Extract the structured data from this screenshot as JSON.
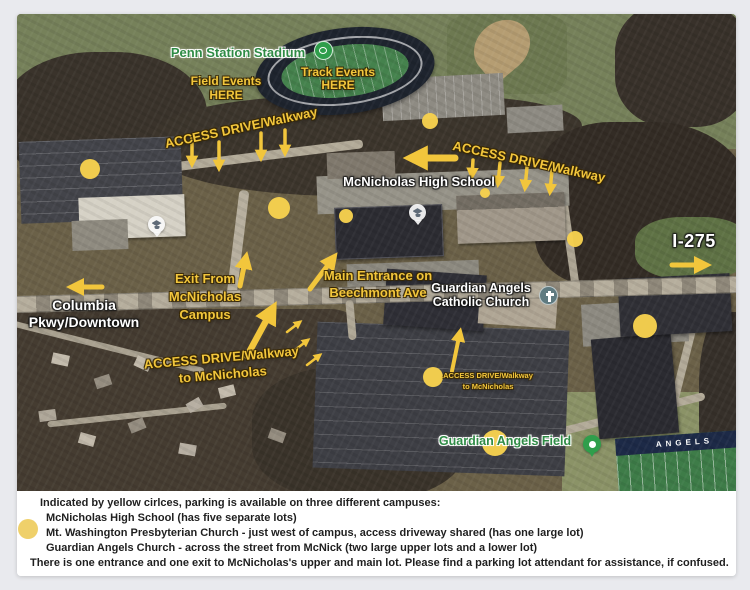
{
  "colors": {
    "accent_yellow": "#F2C63C",
    "parking_circle": "#F6D14E",
    "label_white": "#FFFFFF",
    "label_green": "#2E8B45",
    "legend_text": "#1F1F1F",
    "page_background": "#E9EAEE"
  },
  "map": {
    "labels": {
      "penn_station_stadium": "Penn Station Stadium",
      "track_events_line1": "Track Events",
      "track_events_line2": "HERE",
      "field_events_line1": "Field Events",
      "field_events_line2": "HERE",
      "access_top_left": "ACCESS DRIVE/Walkway",
      "access_top_right": "ACCESS DRIVE/Walkway",
      "school_name": "McNicholas High School",
      "columbia_line1": "Columbia",
      "columbia_line2": "Pkwy/Downtown",
      "exit_line1": "Exit From",
      "exit_line2": "McNicholas",
      "exit_line3": "Campus",
      "main_entrance_line1": "Main Entrance on",
      "main_entrance_line2": "Beechmont Ave",
      "access_mid_line1": "ACCESS DRIVE/Walkway",
      "access_mid_line2": "to McNicholas",
      "church_line1": "Guardian Angels",
      "church_line2": "Catholic Church",
      "access_small_line1": "ACCESS DRIVE/Walkway",
      "access_small_line2": "to McNicholas",
      "highway": "I-275",
      "field_label": "Guardian Angels Field",
      "endzone": "ANGELS"
    },
    "icons": {
      "stadium_icon": "track-stadium-icon",
      "school_marker": "graduation-cap-marker",
      "church_marker": "cross-marker",
      "field_pin": "location-pin"
    },
    "parking_circles": [
      {
        "x": 73,
        "y": 155,
        "r": 10
      },
      {
        "x": 413,
        "y": 107,
        "r": 8
      },
      {
        "x": 262,
        "y": 194,
        "r": 11
      },
      {
        "x": 329,
        "y": 202,
        "r": 7
      },
      {
        "x": 468,
        "y": 179,
        "r": 5
      },
      {
        "x": 558,
        "y": 225,
        "r": 8
      },
      {
        "x": 628,
        "y": 312,
        "r": 12
      },
      {
        "x": 416,
        "y": 363,
        "r": 10
      },
      {
        "x": 478,
        "y": 429,
        "r": 13
      }
    ]
  },
  "legend": {
    "line1": "Indicated by yellow cirlces, parking is available on three different campuses:",
    "line2": "McNicholas High School (has five separate lots)",
    "line3": "Mt. Washington Presbyterian Church - just west of campus, access driveway shared (has one large lot)",
    "line4": "Guardian Angels Church - across the street from McNick (two large upper lots and a lower lot)",
    "line5": "There is one entrance and one exit to McNicholas's upper and main lot. Please find a parking lot attendant for assistance, if confused."
  }
}
